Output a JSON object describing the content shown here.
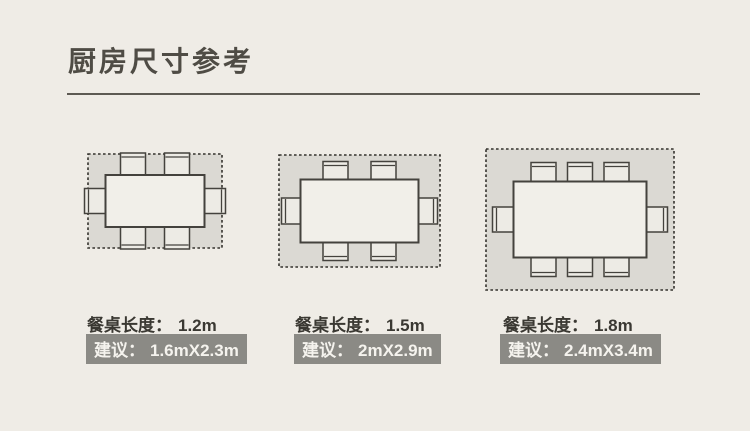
{
  "page": {
    "title": "厨房尺寸参考",
    "background_color": "#efece6",
    "colors": {
      "zone_fill": "#dbd9d3",
      "outline": "#44423d",
      "dashed_border": "#34322d",
      "table_fill": "#f1efe9",
      "chair_fill": "#edebe5",
      "badge_bg": "#8b8a85",
      "badge_text": "#f5f3ee",
      "label_text": "#3a3832",
      "title_text": "#4f4c45"
    }
  },
  "diagrams": [
    {
      "name": "dining-set-small",
      "table_length_label": "餐桌长度：",
      "table_length_value": "1.2m",
      "suggestion_label": "建议：",
      "suggestion_value": "1.6mX2.3m",
      "seats": {
        "top": 2,
        "bottom": 2,
        "left": 1,
        "right": 1
      }
    },
    {
      "name": "dining-set-medium",
      "table_length_label": "餐桌长度：",
      "table_length_value": "1.5m",
      "suggestion_label": "建议：",
      "suggestion_value": "2mX2.9m",
      "seats": {
        "top": 2,
        "bottom": 2,
        "left": 1,
        "right": 1
      }
    },
    {
      "name": "dining-set-large",
      "table_length_label": "餐桌长度：",
      "table_length_value": "1.8m",
      "suggestion_label": "建议：",
      "suggestion_value": "2.4mX3.4m",
      "seats": {
        "top": 3,
        "bottom": 3,
        "left": 1,
        "right": 1
      }
    }
  ]
}
